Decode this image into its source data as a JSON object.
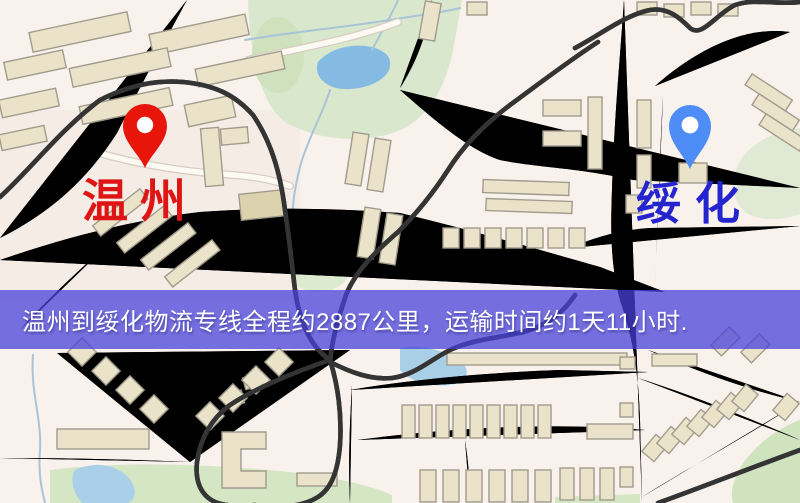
{
  "banner": {
    "text": "温州到绥化物流专线全程约2887公里，运输时间约1天11小时.",
    "distance_km": "2887",
    "duration": "1天11小时",
    "background_color": "#4640db",
    "text_color": "#ffffff"
  },
  "markers": {
    "origin": {
      "label": "温州",
      "pin_color": "#e8150b",
      "label_color": "#df1414"
    },
    "destination": {
      "label": "绥化",
      "pin_color": "#4e8cf6",
      "label_color": "#2525cf"
    }
  },
  "map": {
    "colors": {
      "background": "#f8f1ec",
      "road_fill": "#f3cf63",
      "road_casing": "#e2b44e",
      "railway": "#343434",
      "building": "#ebe3c9",
      "park": "#d9e8cc",
      "water": "#85bbe2"
    }
  }
}
